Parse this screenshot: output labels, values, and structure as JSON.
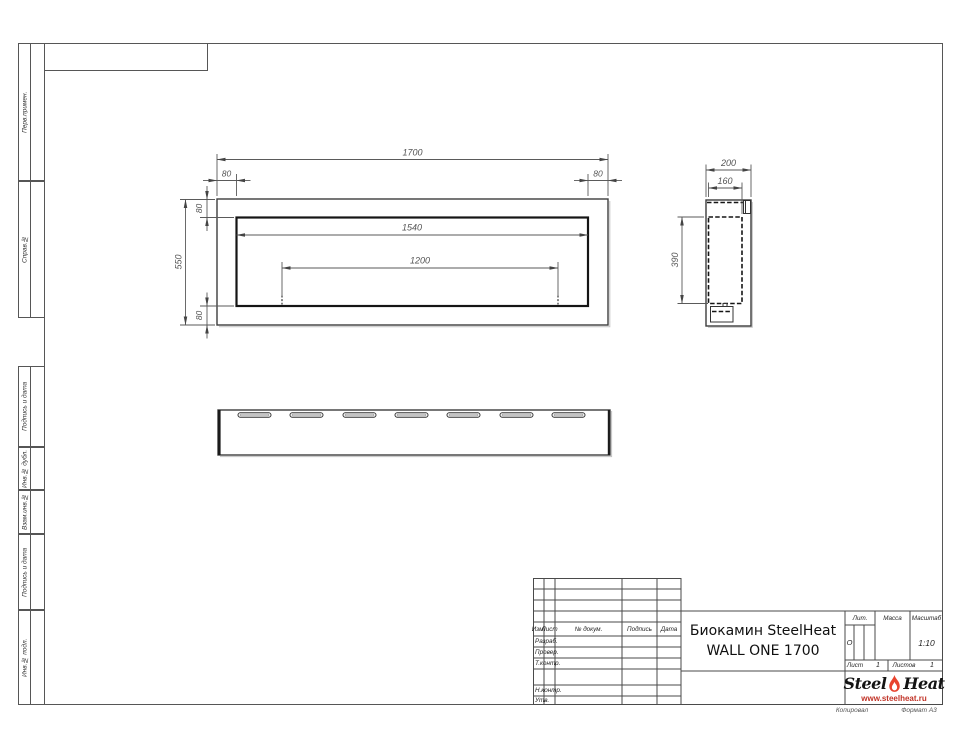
{
  "side_columns": [
    {
      "label": "Перв.примен."
    },
    {
      "label": "Справ.№"
    },
    {
      "label": "Подпись и дата"
    },
    {
      "label": "Инв.№ дубл."
    },
    {
      "label": "Взам.инв.№"
    },
    {
      "label": "Подпись и дата"
    },
    {
      "label": "Инв.№ подл."
    }
  ],
  "drawing": {
    "front_view": {
      "dims": {
        "total_width": "1700",
        "inset_left": "80",
        "inset_right": "80",
        "inner_width": "1540",
        "mount_span": "1200",
        "total_height": "550",
        "inset_top": "80",
        "inset_bottom": "80"
      }
    },
    "side_view": {
      "dims": {
        "depth": "200",
        "inner_depth": "160",
        "inner_height": "390"
      }
    },
    "bottom_view": {
      "slot_count": 7
    }
  },
  "title_block": {
    "columns": {
      "izm": "Изм.",
      "list": "Лист",
      "doc": "№ докум.",
      "sign": "Подпись",
      "date": "Дата"
    },
    "rows": {
      "razrab": "Разраб.",
      "prover": "Провер.",
      "tkontr": "Т.контр.",
      "nkontr": "Н.контр.",
      "utv": "Утв."
    },
    "title_line1": "Биокамин SteelHeat",
    "title_line2": "WALL ONE 1700",
    "lit_label": "Лит.",
    "lit_value": "О",
    "massa_label": "Масса",
    "masshtab_label": "Масштаб",
    "masshtab_value": "1:10",
    "list_label": "Лист",
    "list_value": "1",
    "listov_label": "Листов",
    "listov_value": "1",
    "logo": {
      "steel": "Steel",
      "heat": "Heat",
      "url": "www.steelheat.ru",
      "flame_color": "#e8432e"
    }
  },
  "footer": {
    "copy_note": "Копировал",
    "format_note": "Формат А3"
  }
}
